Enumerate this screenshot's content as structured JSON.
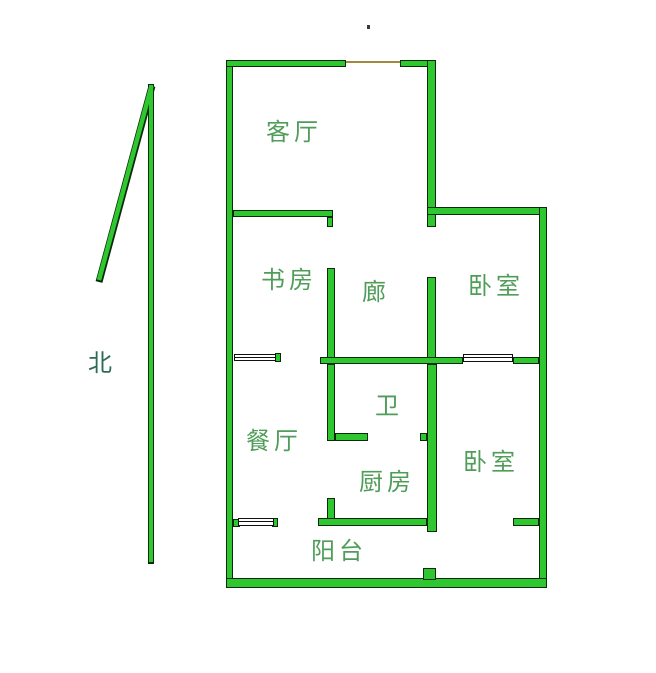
{
  "palette": {
    "background": "#ffffff",
    "wall_fill": "#2fc72f",
    "wall_outline": "#0b290b",
    "window_fill": "#ffffff",
    "window_outline": "#101010",
    "opening_color": "#a08a3c",
    "label_color": "#4f9d58",
    "compass_label_color": "#2e6b55"
  },
  "compass": {
    "label": "北",
    "label_x": 88,
    "label_y": 352
  },
  "floorplan": {
    "rooms": [
      {
        "id": "living-room",
        "name": "客厅",
        "x": 266,
        "y": 121
      },
      {
        "id": "study",
        "name": "书房",
        "x": 261,
        "y": 269
      },
      {
        "id": "corridor",
        "name": "廊",
        "x": 362,
        "y": 281
      },
      {
        "id": "bedroom-north",
        "name": "卧室",
        "x": 468,
        "y": 275
      },
      {
        "id": "bathroom",
        "name": "卫",
        "x": 375,
        "y": 395
      },
      {
        "id": "dining-room",
        "name": "餐厅",
        "x": 246,
        "y": 430
      },
      {
        "id": "kitchen",
        "name": "厨房",
        "x": 359,
        "y": 471
      },
      {
        "id": "bedroom-south",
        "name": "卧室",
        "x": 463,
        "y": 451
      },
      {
        "id": "balcony",
        "name": "阳台",
        "x": 311,
        "y": 540
      }
    ],
    "walls": [
      {
        "x": 226,
        "y": 60,
        "w": 7,
        "h": 528
      },
      {
        "x": 226,
        "y": 60,
        "w": 120,
        "h": 7
      },
      {
        "x": 400,
        "y": 60,
        "w": 34,
        "h": 7
      },
      {
        "x": 427,
        "y": 60,
        "w": 9,
        "h": 167
      },
      {
        "x": 427,
        "y": 277,
        "w": 9,
        "h": 87
      },
      {
        "x": 427,
        "y": 207,
        "w": 120,
        "h": 8
      },
      {
        "x": 539,
        "y": 207,
        "w": 8,
        "h": 381
      },
      {
        "x": 226,
        "y": 578,
        "w": 321,
        "h": 10
      },
      {
        "x": 233,
        "y": 210,
        "w": 100,
        "h": 7
      },
      {
        "x": 327,
        "y": 217,
        "w": 6,
        "h": 10
      },
      {
        "x": 327,
        "y": 268,
        "w": 8,
        "h": 96
      },
      {
        "x": 320,
        "y": 357,
        "w": 143,
        "h": 7
      },
      {
        "x": 513,
        "y": 357,
        "w": 26,
        "h": 7
      },
      {
        "x": 275,
        "y": 353,
        "w": 6,
        "h": 9
      },
      {
        "x": 327,
        "y": 364,
        "w": 8,
        "h": 77
      },
      {
        "x": 335,
        "y": 433,
        "w": 33,
        "h": 8
      },
      {
        "x": 420,
        "y": 433,
        "w": 7,
        "h": 8
      },
      {
        "x": 427,
        "y": 364,
        "w": 10,
        "h": 168
      },
      {
        "x": 327,
        "y": 498,
        "w": 8,
        "h": 21
      },
      {
        "x": 318,
        "y": 518,
        "w": 109,
        "h": 8
      },
      {
        "x": 233,
        "y": 519,
        "w": 7,
        "h": 8
      },
      {
        "x": 272,
        "y": 518,
        "w": 6,
        "h": 9
      },
      {
        "x": 513,
        "y": 518,
        "w": 26,
        "h": 8
      },
      {
        "x": 423,
        "y": 568,
        "w": 13,
        "h": 12
      }
    ],
    "windows": [
      {
        "x": 234,
        "y": 354,
        "w": 42,
        "h": 7
      },
      {
        "x": 463,
        "y": 354,
        "w": 50,
        "h": 8
      },
      {
        "x": 238,
        "y": 518,
        "w": 36,
        "h": 8
      }
    ],
    "opening": {
      "x": 346,
      "y": 61,
      "w": 56,
      "h": 2
    },
    "stray_mark": {
      "x": 367,
      "y": 25
    }
  }
}
